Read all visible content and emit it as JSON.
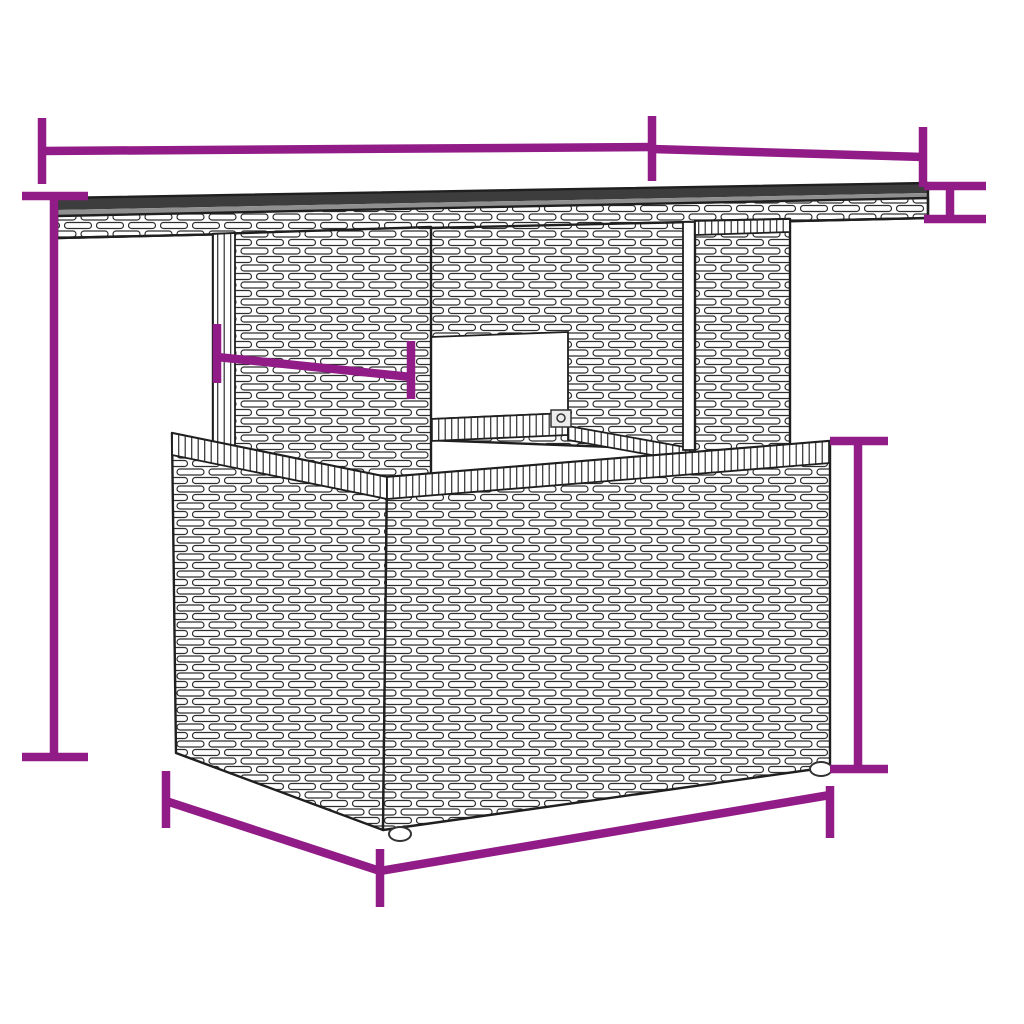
{
  "page": {
    "background": "#ffffff"
  },
  "illustration": {
    "subject": "poly-rattan garden table, perspective line drawing",
    "accent_color": "#911b87",
    "line_color": "#2f2f2f",
    "tabletop_color": "#3d3d3d"
  },
  "dimensions": {
    "tabletop_width": "100 cm( 39.3″ )",
    "tabletop_depth": "55 cm( 21.7″ )",
    "tabletop_thickness": "4 cm( 1.6″ )",
    "total_height": "73 cm( 28.7″ )",
    "pedestal_width": "49 cm( 19.2″ )",
    "base_height": "42 cm( 16.5″ )",
    "base_depth": "55 cm( 21.7″ )",
    "base_width": "68 cm( 26.7″ )"
  }
}
